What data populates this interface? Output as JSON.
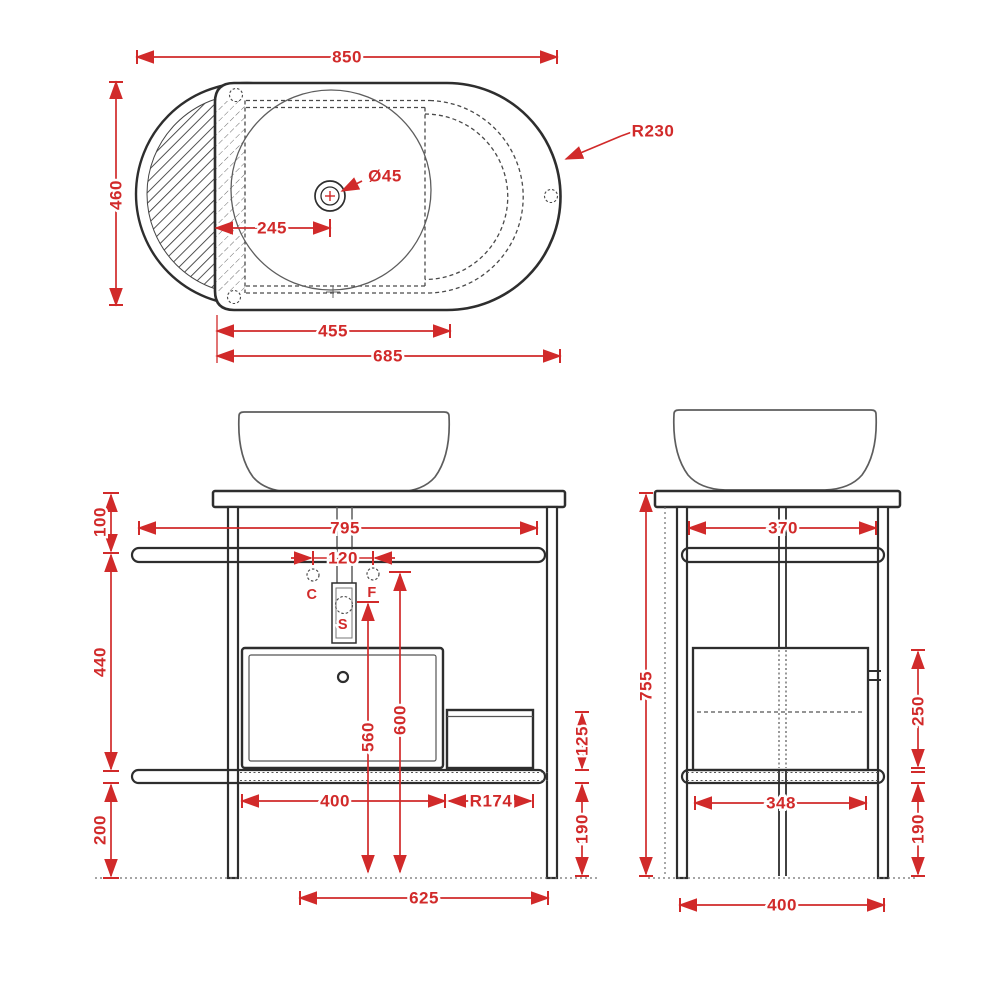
{
  "drawing_title": "Vanity console with vessel basin - dimensional drawing",
  "colors": {
    "dimension": "#d12a2a",
    "line": "#2e2e2e",
    "background": "#ffffff"
  },
  "top_view": {
    "overall_width": "850",
    "overall_depth": "460",
    "end_radius": "R230",
    "drain_diameter": "Ø45",
    "drain_offset": "245",
    "basin_width": "455",
    "deck_width": "685"
  },
  "front_view": {
    "console_width": "795",
    "top_to_rail": "100",
    "rail_to_rail": "440",
    "rail_to_floor_left": "200",
    "tap_spacing": "120",
    "cold": "C",
    "hot": "F",
    "waste": "S",
    "waste_height": "560",
    "underside_height": "600",
    "drawer_width": "400",
    "shelf_radius": "R174",
    "side_shelf_height": "125",
    "rail_to_floor_right": "190",
    "leg_spacing": "625"
  },
  "side_view": {
    "inner_depth": "370",
    "total_height": "755",
    "drawer_height": "250",
    "rail_to_floor": "190",
    "drawer_depth": "348",
    "overall_depth": "400"
  }
}
